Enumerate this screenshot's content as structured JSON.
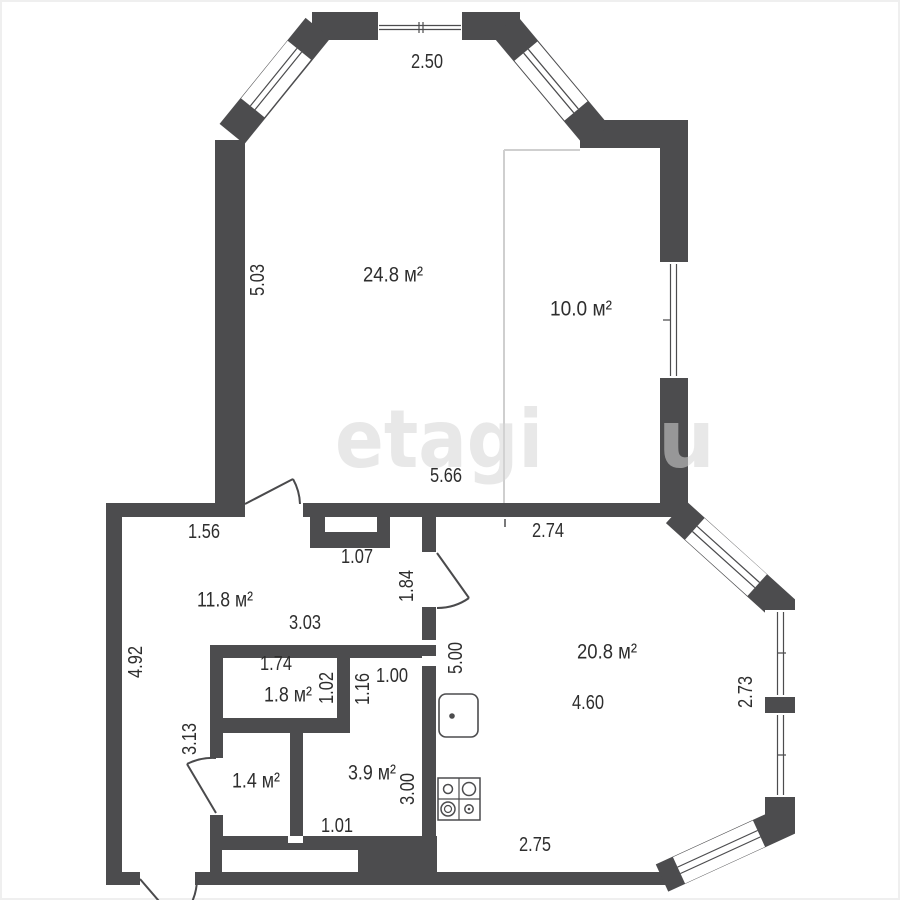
{
  "plan": {
    "type": "apartment-floor-plan",
    "watermark": {
      "text": "etagi",
      "partial": "u"
    },
    "colors": {
      "wall": "#4c4c4e",
      "text": "#2e2e2e",
      "thin_line": "#cfcfcf"
    },
    "rooms": [
      {
        "id": "living-room",
        "area": "24.8 м²"
      },
      {
        "id": "alcove-room",
        "area": "10.0 м²"
      },
      {
        "id": "hallway",
        "area": "11.8 м²"
      },
      {
        "id": "bathroom",
        "area": "1.8 м²"
      },
      {
        "id": "wc",
        "area": "1.4 м²"
      },
      {
        "id": "storage",
        "area": "3.9 м²"
      },
      {
        "id": "kitchen-living",
        "area": "20.8 м²"
      }
    ],
    "dimensions": [
      {
        "id": "top-width",
        "value": "2.50"
      },
      {
        "id": "left-height-upper",
        "value": "5.03"
      },
      {
        "id": "living-bottom-width",
        "value": "5.66"
      },
      {
        "id": "alcove-bottom-width",
        "value": "2.74"
      },
      {
        "id": "hall-top-width",
        "value": "1.56"
      },
      {
        "id": "shaft-width",
        "value": "1.07"
      },
      {
        "id": "hall-door-height",
        "value": "1.84"
      },
      {
        "id": "hall-width",
        "value": "3.03"
      },
      {
        "id": "left-height-lower",
        "value": "4.92"
      },
      {
        "id": "bathroom-width",
        "value": "1.74"
      },
      {
        "id": "bathroom-height",
        "value": "1.02"
      },
      {
        "id": "passage-height",
        "value": "1.16"
      },
      {
        "id": "passage-width",
        "value": "1.00"
      },
      {
        "id": "kitchen-left-height",
        "value": "5.00"
      },
      {
        "id": "corridor-height",
        "value": "3.13"
      },
      {
        "id": "storage-bottom-width",
        "value": "1.01"
      },
      {
        "id": "storage-height",
        "value": "3.00"
      },
      {
        "id": "kitchen-width",
        "value": "4.60"
      },
      {
        "id": "kitchen-bottom-width",
        "value": "2.75"
      },
      {
        "id": "kitchen-right-height",
        "value": "2.73"
      }
    ]
  }
}
